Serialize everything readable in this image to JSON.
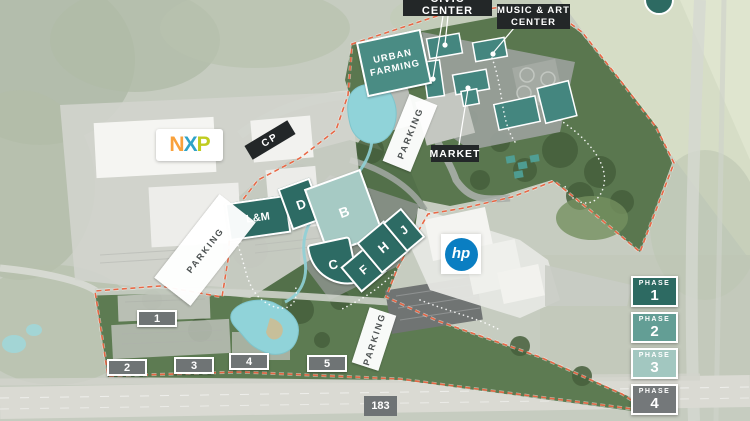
{
  "map": {
    "area_labels": {
      "civic_center": "CIVIC CENTER",
      "music_art_line1": "MUSIC & ART",
      "music_art_line2": "CENTER",
      "urban_farming_line1": "URBAN",
      "urban_farming_line2": "FARMING",
      "market": "MARKET",
      "cp": "CP",
      "parking": "PARKING",
      "highway_183": "183"
    },
    "logos": {
      "nxp_letters": [
        "N",
        "X",
        "P"
      ],
      "hp": "hp"
    },
    "buildings": {
      "lm": "L&M",
      "d": "D",
      "b": "B",
      "c": "C",
      "f": "F",
      "h": "H",
      "j": "J"
    },
    "numbered_sites": [
      "1",
      "2",
      "3",
      "4",
      "5"
    ],
    "legend_phases": [
      {
        "title": "PHASE",
        "number": "1",
        "color": "#2d6a62"
      },
      {
        "title": "PHASE",
        "number": "2",
        "color": "#639e95"
      },
      {
        "title": "PHASE",
        "number": "3",
        "color": "#a2c7c0"
      },
      {
        "title": "PHASE",
        "number": "4",
        "color": "#74787a"
      }
    ],
    "colors": {
      "building_dark_teal": "#2d6b64",
      "building_light_teal": "#a6cac4",
      "civic_building_teal": "#44867f",
      "site_boundary": "#e8613d",
      "label_background": "#232728",
      "hp_blue": "#0a7ec2",
      "water": "#90d3d9"
    }
  }
}
